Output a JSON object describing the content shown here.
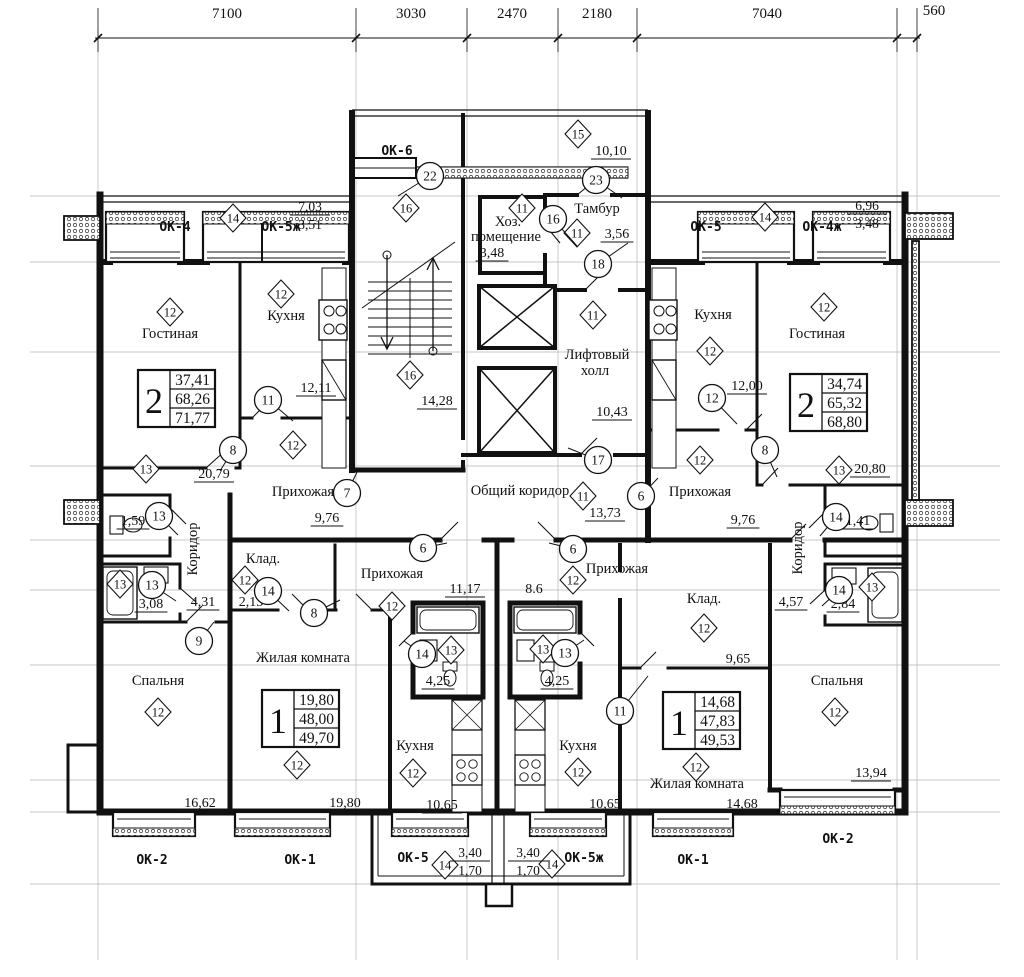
{
  "top_dimensions": [
    "7100",
    "3030",
    "2470",
    "2180",
    "7040",
    "560"
  ],
  "apartment_tables": [
    {
      "id": "apt2-left",
      "rooms": "2",
      "living_area": "37,41",
      "floor_area": "68,26",
      "total_area": "71,77"
    },
    {
      "id": "apt2-right",
      "rooms": "2",
      "living_area": "34,74",
      "floor_area": "65,32",
      "total_area": "68,80"
    },
    {
      "id": "apt1-left",
      "rooms": "1",
      "living_area": "19,80",
      "floor_area": "48,00",
      "total_area": "49,70"
    },
    {
      "id": "apt1-right",
      "rooms": "1",
      "living_area": "14,68",
      "floor_area": "47,83",
      "total_area": "49,53"
    }
  ],
  "rooms": [
    {
      "id": "living-left",
      "name": "Гостиная",
      "name2": "",
      "marker": "12",
      "area": "20,79"
    },
    {
      "id": "kitchen-left",
      "name": "Кухня",
      "name2": "",
      "marker": "12",
      "area": "12,11"
    },
    {
      "id": "hall-left",
      "name": "Прихожая",
      "name2": "",
      "marker": "12",
      "area": "9,76"
    },
    {
      "id": "wc-left",
      "name": "",
      "name2": "",
      "marker": "",
      "area": "1,59"
    },
    {
      "id": "bath-left",
      "name": "",
      "name2": "",
      "marker": "13",
      "area": "3,08"
    },
    {
      "id": "corridor-left",
      "name": "Коридор",
      "name2": "",
      "marker": "",
      "area": "4,31"
    },
    {
      "id": "bedroom-left",
      "name": "Спальня",
      "name2": "",
      "marker": "12",
      "area": "16,62"
    },
    {
      "id": "kitchen-right",
      "name": "Кухня",
      "name2": "",
      "marker": "12",
      "area": "12,00"
    },
    {
      "id": "living-right",
      "name": "Гостиная",
      "name2": "",
      "marker": "12",
      "area": "20,80"
    },
    {
      "id": "hall-right",
      "name": "Прихожая",
      "name2": "",
      "marker": "12",
      "area": "9,76"
    },
    {
      "id": "wc-right",
      "name": "",
      "name2": "",
      "marker": "",
      "area": "1,41"
    },
    {
      "id": "bath-right",
      "name": "",
      "name2": "",
      "marker": "13",
      "area": "2,84"
    },
    {
      "id": "corridor-right",
      "name": "Коридор",
      "name2": "",
      "marker": "",
      "area": "4,57"
    },
    {
      "id": "bedroom-right",
      "name": "Спальня",
      "name2": "",
      "marker": "12",
      "area": "13,94"
    },
    {
      "id": "utility",
      "name": "Хоз.",
      "name2": "помещение",
      "marker": "11",
      "area": "3,48"
    },
    {
      "id": "tambour",
      "name": "Тамбур",
      "name2": "",
      "marker": "11",
      "area": "3,56"
    },
    {
      "id": "entry-porch",
      "name": "",
      "name2": "",
      "marker": "15",
      "area": "10,10"
    },
    {
      "id": "stairwell",
      "name": "",
      "name2": "",
      "marker": "16",
      "area": "14,28"
    },
    {
      "id": "lift-hall",
      "name": "Лифтовый",
      "name2": "холл",
      "marker": "11",
      "area": "10,43"
    },
    {
      "id": "common-corridor",
      "name": "Общий коридор",
      "name2": "",
      "marker": "11",
      "area": "13,73"
    },
    {
      "id": "hall-bottom-left",
      "name": "Прихожая",
      "name2": "",
      "marker": "12",
      "area": "11,17"
    },
    {
      "id": "storage-bottom-left",
      "name": "Клад.",
      "name2": "",
      "marker": "12",
      "area": "2,13"
    },
    {
      "id": "living-bottom-left",
      "name": "Жилая комната",
      "name2": "",
      "marker": "12",
      "area": "19,80"
    },
    {
      "id": "bath-bottom-left",
      "name": "",
      "name2": "",
      "marker": "13",
      "area": "4,25"
    },
    {
      "id": "kitchen-bottom-left",
      "name": "Кухня",
      "name2": "",
      "marker": "12",
      "area": "10,65"
    },
    {
      "id": "hall-bottom-right",
      "name": "Прихожая",
      "name2": "",
      "marker": "12",
      "area": "8.6"
    },
    {
      "id": "storage-bottom-right",
      "name": "Клад.",
      "name2": "",
      "marker": "12",
      "area": "9,65"
    },
    {
      "id": "living-bottom-right",
      "name": "Жилая комната",
      "name2": "",
      "marker": "12",
      "area": "14,68"
    },
    {
      "id": "bath-bottom-right",
      "name": "",
      "name2": "",
      "marker": "13",
      "area": "4,25"
    },
    {
      "id": "kitchen-bottom-right",
      "name": "Кухня",
      "name2": "",
      "marker": "12",
      "area": "10,65"
    }
  ],
  "door_marks": [
    {
      "id": "dm22",
      "number": "22"
    },
    {
      "id": "dm23",
      "number": "23"
    },
    {
      "id": "dm16",
      "number": "16"
    },
    {
      "id": "dm18",
      "number": "18"
    },
    {
      "id": "dm17",
      "number": "17"
    },
    {
      "id": "dm11-left",
      "number": "11"
    },
    {
      "id": "dm12-right",
      "number": "12"
    },
    {
      "id": "dm8-left",
      "number": "8"
    },
    {
      "id": "dm8-right",
      "number": "8"
    },
    {
      "id": "dm7",
      "number": "7"
    },
    {
      "id": "dm6-right",
      "number": "6"
    },
    {
      "id": "dm6-bl",
      "number": "6"
    },
    {
      "id": "dm6-br",
      "number": "6"
    },
    {
      "id": "dm13-wc-left",
      "number": "13"
    },
    {
      "id": "dm13-bath-left",
      "number": "13"
    },
    {
      "id": "dm14-wc-right",
      "number": "14"
    },
    {
      "id": "dm14-bath-right",
      "number": "14"
    },
    {
      "id": "dm9",
      "number": "9"
    },
    {
      "id": "dm14-storage-bl",
      "number": "14"
    },
    {
      "id": "dm8-bl",
      "number": "8"
    },
    {
      "id": "dm11-br",
      "number": "11"
    },
    {
      "id": "dm14-bath-bl",
      "number": "14"
    },
    {
      "id": "dm13-bath-br",
      "number": "13"
    }
  ],
  "floor_markers": [
    {
      "id": "fm14-balc-tl",
      "number": "14"
    },
    {
      "id": "fm14-balc-tr",
      "number": "14"
    },
    {
      "id": "fm13-tl",
      "number": "13"
    },
    {
      "id": "fm13-tr",
      "number": "13"
    },
    {
      "id": "fm16-upper",
      "number": "16"
    },
    {
      "id": "fm14-balc-bl",
      "number": "14"
    },
    {
      "id": "fm14-balc-br",
      "number": "14"
    }
  ],
  "window_labels": [
    {
      "id": "ok4-tl",
      "text": "ОК-4"
    },
    {
      "id": "ok5zh-tl",
      "text": "ОК-5ж"
    },
    {
      "id": "ok6",
      "text": "ОК-6"
    },
    {
      "id": "ok5-tr",
      "text": "ОК-5"
    },
    {
      "id": "ok4zh-tr",
      "text": "ОК-4ж"
    },
    {
      "id": "ok2-bl",
      "text": "ОК-2"
    },
    {
      "id": "ok1-bl",
      "text": "ОК-1"
    },
    {
      "id": "ok5-bb",
      "text": "ОК-5"
    },
    {
      "id": "ok5zh-bb",
      "text": "ОК-5ж"
    },
    {
      "id": "ok1-br",
      "text": "ОК-1"
    },
    {
      "id": "ok2-br",
      "text": "ОК-2"
    }
  ],
  "balcony_fractions": [
    {
      "id": "fr-tl",
      "top": "7,03",
      "bottom": "3,51"
    },
    {
      "id": "fr-tr",
      "top": "6,96",
      "bottom": "3,48"
    },
    {
      "id": "fr-bl",
      "top": "3,40",
      "bottom": "1,70"
    },
    {
      "id": "fr-br",
      "top": "3,40",
      "bottom": "1,70"
    }
  ]
}
